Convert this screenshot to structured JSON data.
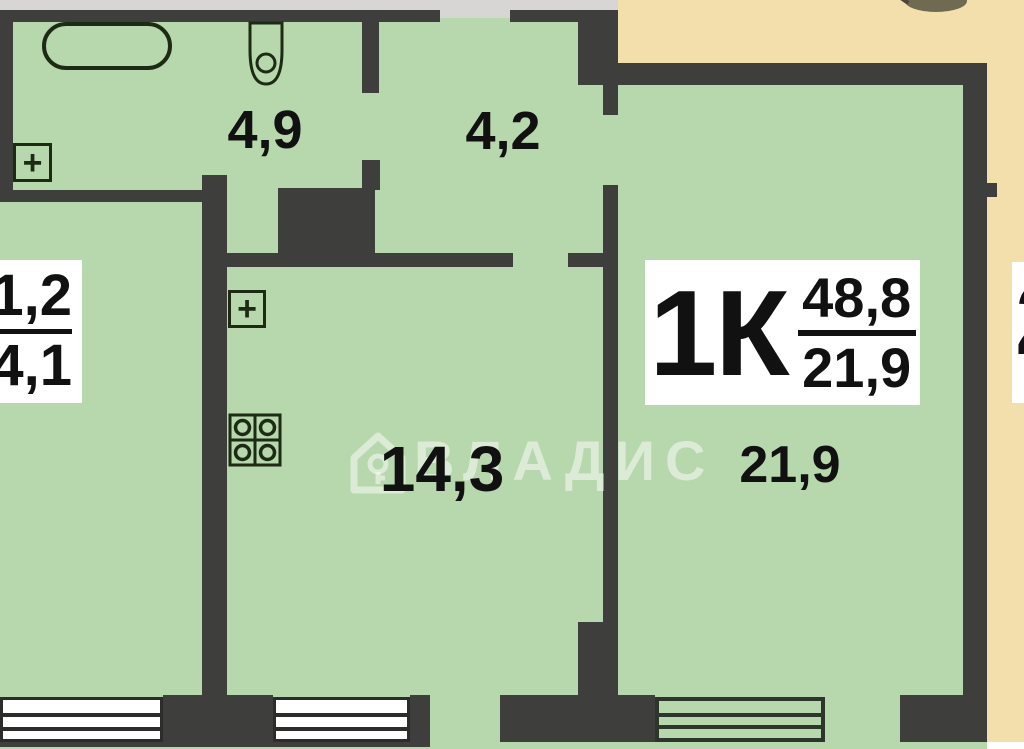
{
  "watermark": {
    "text": "ВЛАДИС"
  },
  "apartment_badge": {
    "type": "1К",
    "area_total": "48,8",
    "area_living": "21,9"
  },
  "rooms": {
    "bathroom": {
      "area": "4,9"
    },
    "hallway": {
      "area": "4,2"
    },
    "kitchen": {
      "area": "14,3"
    },
    "living": {
      "area": "21,9"
    }
  },
  "neighbor_left_badge": {
    "top": "1,2",
    "bottom": "4,1"
  },
  "neighbor_right_badge": {
    "partial_digit": "2"
  },
  "colors": {
    "wall": "#3e3e3c",
    "room": "#b7d7ad",
    "tan": "#f2dfac",
    "gray": "#d8d6d4",
    "fix": "#1d2b15",
    "ink": "#111111",
    "wm": "rgba(255,255,255,0.5)"
  }
}
